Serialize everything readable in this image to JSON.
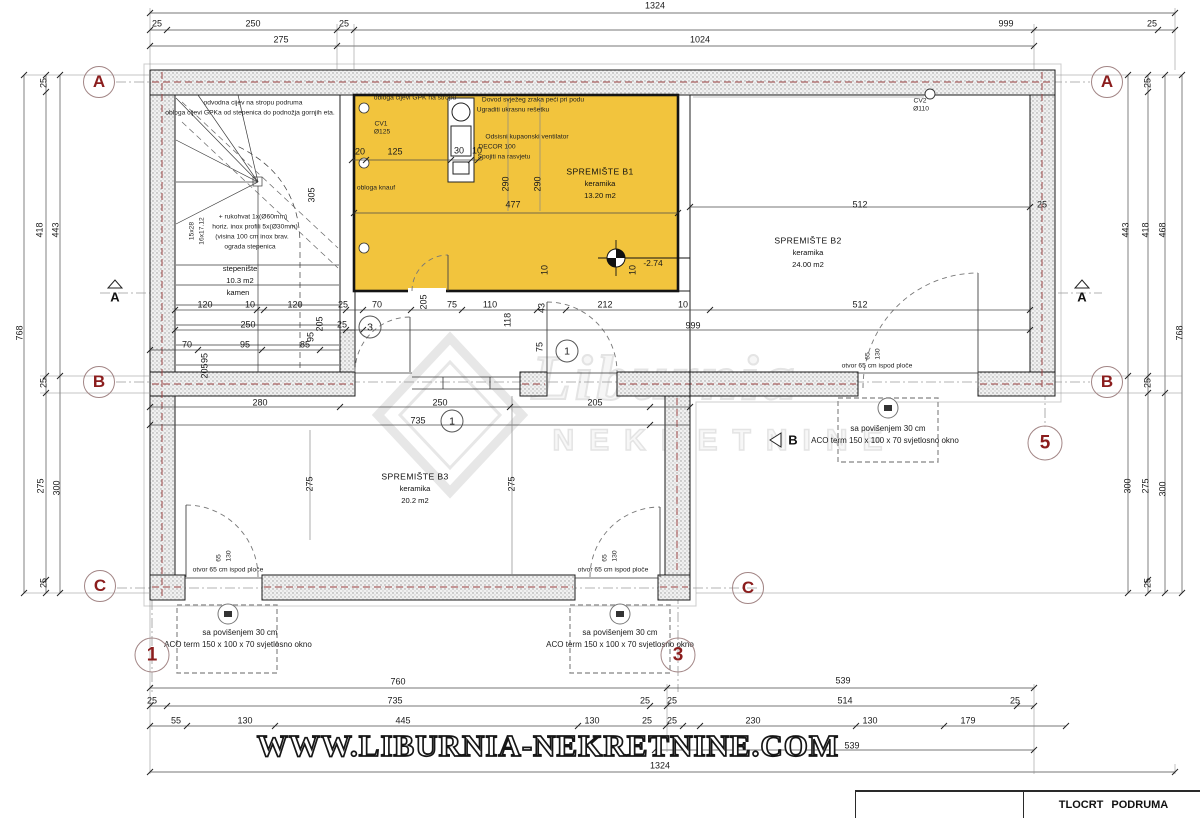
{
  "title_block": {
    "title": "TLOCRT PODRUMA"
  },
  "watermark": {
    "url": "WWW.LIBURNIA-NEKRETNINE.COM",
    "logo_word": "Liburnia",
    "logo_sub": "NEKRETNINE"
  },
  "grid_bubbles": {
    "a": "A",
    "b": "B",
    "c": "C",
    "n1": "1",
    "n3": "3",
    "n5": "5"
  },
  "section_marks": {
    "a": "A",
    "b": "B"
  },
  "door_numbers": {
    "d1": "1",
    "d3": "3"
  },
  "rooms": {
    "b1": {
      "name": "SPREMIŠTE B1",
      "finish": "keramika",
      "area": "13.20 m2"
    },
    "b2": {
      "name": "SPREMIŠTE B2",
      "finish": "keramika",
      "area": "24.00 m2"
    },
    "b3": {
      "name": "SPREMIŠTE B3",
      "finish": "keramika",
      "area": "20.2 m2"
    },
    "stairs": {
      "name": "stepenište",
      "area": "10.3 m2",
      "finish": "kamen"
    }
  },
  "level_marker": {
    "value": "-2.74"
  },
  "vents": {
    "cv1": "CV1",
    "cv1_d": "Ø125",
    "cv2": "CV2",
    "cv2_d": "Ø110"
  },
  "annotations": {
    "stair_pipe1": "odvodna cijev na stropu podruma",
    "stair_pipe2": "obloga cijevi GPKa od stepenica do podnožja gornjih eta.",
    "rail1": "+ rukohvat 1x(Ø60mm)",
    "rail2": "horiz. inox profili 5x(Ø30mm)",
    "rail3": "(visina 100 cm inox brav.",
    "rail4": "ograda stepenica",
    "steps1": "15x28",
    "steps2": "16x17.12",
    "gpk_ceiling": "obloga cijevi GPK na stropu",
    "air1": "Dovod svježeg zraka peći pri podu",
    "air2": "Ugraditi ukrasnu rešetku",
    "vent1": "Odsisni kupaonski ventilator",
    "vent2": "DECOR 100",
    "vent3": "Spojiti na rasvjetu",
    "knauf": "obloga knauf",
    "otvor": "otvor 65 cm ispod ploče",
    "aco1": "sa povišenjem 30 cm",
    "aco2": "ACO term 150 x 100 x 70 svjetlosno okno"
  },
  "dims": {
    "top": [
      "1324",
      "25",
      "250",
      "25",
      "999",
      "25",
      "275",
      "1024"
    ],
    "left": [
      "25",
      "418",
      "443",
      "768",
      "25",
      "275",
      "300",
      "25"
    ],
    "right": [
      "25",
      "443",
      "418",
      "468",
      "768",
      "25",
      "300",
      "275",
      "300",
      "25"
    ],
    "bottom": [
      "760",
      "25",
      "735",
      "25",
      "55",
      "130",
      "445",
      "130",
      "25",
      "539",
      "25",
      "514",
      "25",
      "25",
      "230",
      "130",
      "179",
      "539",
      "1324"
    ],
    "inner": [
      "120",
      "10",
      "120",
      "25",
      "70",
      "75",
      "110",
      "212",
      "10",
      "512",
      "250",
      "25",
      "999",
      "70",
      "95",
      "85",
      "280",
      "250",
      "205",
      "735",
      "205",
      "118",
      "43",
      "205",
      "95",
      "75",
      "512",
      "25",
      "275",
      "275",
      "305",
      "95",
      "205"
    ],
    "b1": [
      "20",
      "125",
      "30",
      "10",
      "290",
      "290",
      "477",
      "10",
      "10"
    ],
    "openings": [
      "65",
      "130"
    ]
  }
}
